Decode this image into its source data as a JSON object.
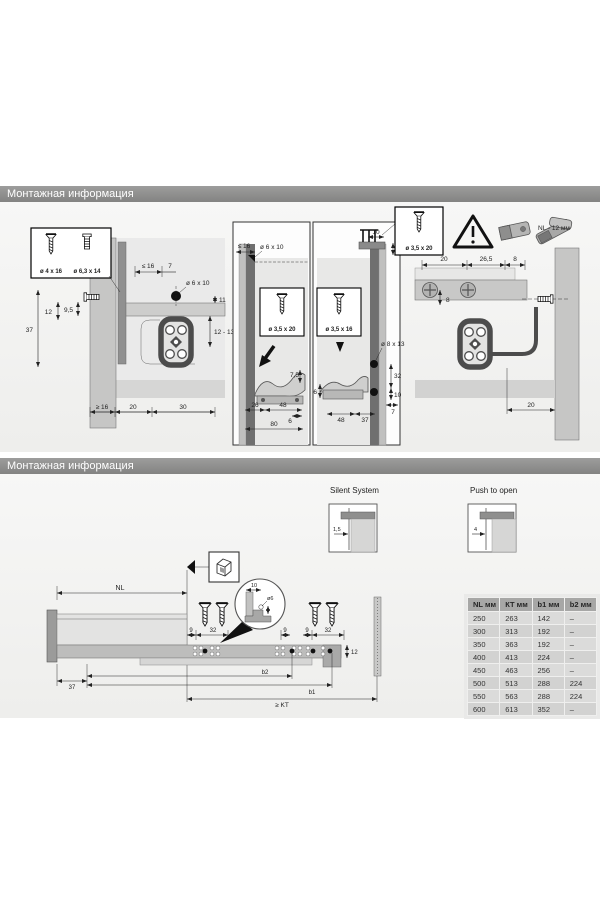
{
  "s1": {
    "title": "Монтажная информация",
    "box": {
      "a": "ø 4 x 16",
      "b": "ø 6,3 x 14"
    },
    "left": {
      "le16": "≤ 16",
      "d7": "7",
      "o6x10": "ø 6 x 10",
      "d11": "11",
      "d12": "12",
      "d95": "9,5",
      "d37": "37",
      "d1213": "12 - 13",
      "ge16": "≥ 16",
      "d20": "20",
      "d30": "30"
    },
    "mid1": {
      "le16": "≤ 16",
      "o6x10": "ø 6 x 10",
      "screw": "ø 3,5 x 20",
      "d75": "7,5",
      "d26": "26",
      "d48": "48",
      "d6": "6",
      "d80": "80"
    },
    "mid2": {
      "d10": "10",
      "d13": "13",
      "screw": "ø 3,5 x 16",
      "o8x13": "ø 8 x 13",
      "d32": "32",
      "d10b": "10",
      "d7": "7",
      "d6": "6",
      "d48": "48",
      "d37": "37"
    },
    "right": {
      "screw": "ø 3,5 x 20",
      "note": "NL - 12 мм",
      "d20": "20",
      "d265": "26,5",
      "d8": "8",
      "d8v": "8",
      "d20b": "20"
    }
  },
  "s2": {
    "title": "Монтажная информация",
    "silent": {
      "label": "Silent System",
      "dim": "1,5"
    },
    "push": {
      "label": "Push to open",
      "dim": "4"
    },
    "draw": {
      "nl": "NL",
      "d9a": "9",
      "d32a": "32",
      "d9b": "9",
      "d9c": "9",
      "d32b": "32",
      "d12": "12",
      "d10": "10",
      "o6": "ø6",
      "d37": "37",
      "b2": "b2",
      "b1": "b1",
      "kt": "≥ KT"
    },
    "table": {
      "headers": [
        "NL мм",
        "КТ мм",
        "b1 мм",
        "b2 мм"
      ],
      "rows": [
        [
          "250",
          "263",
          "142",
          "–"
        ],
        [
          "300",
          "313",
          "192",
          "–"
        ],
        [
          "350",
          "363",
          "192",
          "–"
        ],
        [
          "400",
          "413",
          "224",
          "–"
        ],
        [
          "450",
          "463",
          "256",
          "–"
        ],
        [
          "500",
          "513",
          "288",
          "224"
        ],
        [
          "550",
          "563",
          "288",
          "224"
        ],
        [
          "600",
          "613",
          "352",
          "–"
        ]
      ]
    }
  }
}
